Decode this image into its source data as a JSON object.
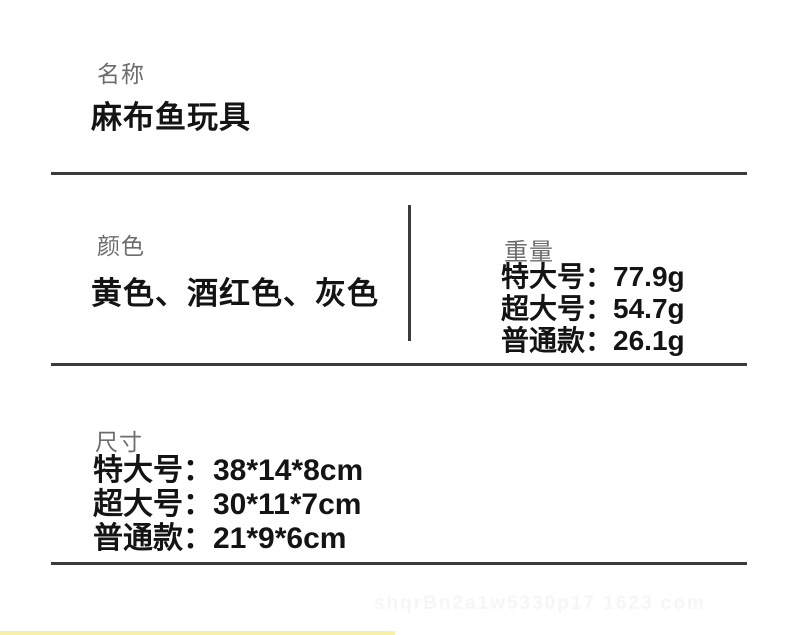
{
  "page": {
    "background_color": "#ffffff",
    "divider_color": "#3b3b3b",
    "label_color": "#6d6d6d",
    "text_color": "#141414",
    "bottom_strip_color": "#f6f1a4"
  },
  "name_section": {
    "label": "名称",
    "value": "麻布鱼玩具"
  },
  "color_section": {
    "label": "颜色",
    "value": "黄色、酒红色、灰色"
  },
  "weight_section": {
    "label": "重量",
    "rows": [
      {
        "label": "特大号：",
        "value": "77.9g"
      },
      {
        "label": "超大号：",
        "value": "54.7g"
      },
      {
        "label": "普通款：",
        "value": "26.1g"
      }
    ]
  },
  "size_section": {
    "label": "尺寸",
    "rows": [
      {
        "label": "特大号：",
        "value": "38*14*8cm"
      },
      {
        "label": "超大号：",
        "value": "30*11*7cm"
      },
      {
        "label": "普通款：",
        "value": "21*9*6cm"
      }
    ]
  },
  "watermark_text": "shqrBn2a1w5330p17 1623 com"
}
